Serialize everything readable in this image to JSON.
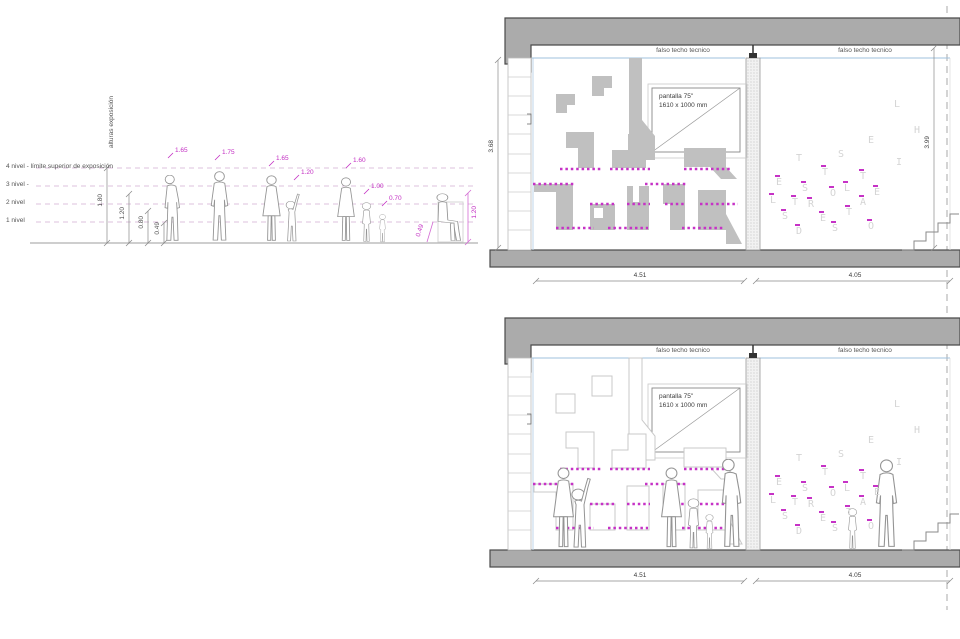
{
  "colors": {
    "magenta_dots": "#c632c6",
    "magenta_labels": "#c32ec3",
    "slab_gray": "#ababab",
    "shape_gray": "#c0c0c0",
    "ceiling_blue": "#9fc0dc",
    "letter_gray": "#d4d4d4",
    "outline_gray": "#949494"
  },
  "scale": {
    "axis_label": "alturas exposición",
    "levels": [
      {
        "label": "4 nivel - límite superior de exposición"
      },
      {
        "label": "3 nivel -"
      },
      {
        "label": "2 nivel"
      },
      {
        "label": "1 nivel"
      }
    ],
    "dims": [
      "1.80",
      "1.20",
      "0.80",
      "0.49"
    ],
    "figures": [
      {
        "type": "man-looking-up",
        "height_label": "1.65"
      },
      {
        "type": "man-standing",
        "height_label": "1.75"
      },
      {
        "type": "woman-standing",
        "height_label": "1.65"
      },
      {
        "type": "child-reaching",
        "height_label": "1.20"
      },
      {
        "type": "woman-standing",
        "height_label": "1.60"
      },
      {
        "type": "child-standing",
        "height_label": "1.00"
      },
      {
        "type": "toddler-standing",
        "height_label": "0.70"
      }
    ],
    "seated_figure": {
      "type": "man-seated",
      "eye_height_label": "1.20",
      "seat_height_label": "0.49"
    }
  },
  "sections": {
    "top": {
      "ceiling_label_left": "falso techo tecnico",
      "ceiling_label_right": "falso techo tecnico",
      "screen_line1": "pantalla 75\"",
      "screen_line2": "1610 x 1000 mm",
      "room_width_left": "4.51",
      "room_width_right": "4.05",
      "room_height_left": "3.68",
      "room_height_right": "3.99"
    },
    "bottom": {
      "ceiling_label_left": "falso techo tecnico",
      "ceiling_label_right": "falso techo tecnico",
      "screen_line1": "pantalla 75\"",
      "screen_line2": "1610 x 1000 mm",
      "room_width_left": "4.51",
      "room_width_right": "4.05"
    }
  },
  "letters": [
    {
      "ch": "L",
      "x": 126,
      "y": 6,
      "tick": false
    },
    {
      "ch": "H",
      "x": 146,
      "y": 32,
      "tick": false
    },
    {
      "ch": "E",
      "x": 100,
      "y": 42,
      "tick": false
    },
    {
      "ch": "S",
      "x": 70,
      "y": 56,
      "tick": false
    },
    {
      "ch": "T",
      "x": 28,
      "y": 60,
      "tick": false
    },
    {
      "ch": "I",
      "x": 128,
      "y": 64,
      "tick": false
    },
    {
      "ch": "T",
      "x": 54,
      "y": 74,
      "tick": true
    },
    {
      "ch": "E",
      "x": 8,
      "y": 84,
      "tick": true
    },
    {
      "ch": "T",
      "x": 92,
      "y": 78,
      "tick": true
    },
    {
      "ch": "S",
      "x": 34,
      "y": 90,
      "tick": true
    },
    {
      "ch": "L",
      "x": 76,
      "y": 90,
      "tick": true
    },
    {
      "ch": "E",
      "x": 106,
      "y": 94,
      "tick": true
    },
    {
      "ch": "L",
      "x": 2,
      "y": 102,
      "tick": true
    },
    {
      "ch": "O",
      "x": 62,
      "y": 95,
      "tick": true
    },
    {
      "ch": "T",
      "x": 24,
      "y": 104,
      "tick": true
    },
    {
      "ch": "R",
      "x": 40,
      "y": 106,
      "tick": true
    },
    {
      "ch": "A",
      "x": 92,
      "y": 104,
      "tick": true
    },
    {
      "ch": "S",
      "x": 14,
      "y": 118,
      "tick": true
    },
    {
      "ch": "E",
      "x": 52,
      "y": 120,
      "tick": true
    },
    {
      "ch": "T",
      "x": 78,
      "y": 114,
      "tick": true
    },
    {
      "ch": "S",
      "x": 64,
      "y": 130,
      "tick": true
    },
    {
      "ch": "D",
      "x": 28,
      "y": 133,
      "tick": true
    },
    {
      "ch": "O",
      "x": 100,
      "y": 128,
      "tick": true
    }
  ]
}
